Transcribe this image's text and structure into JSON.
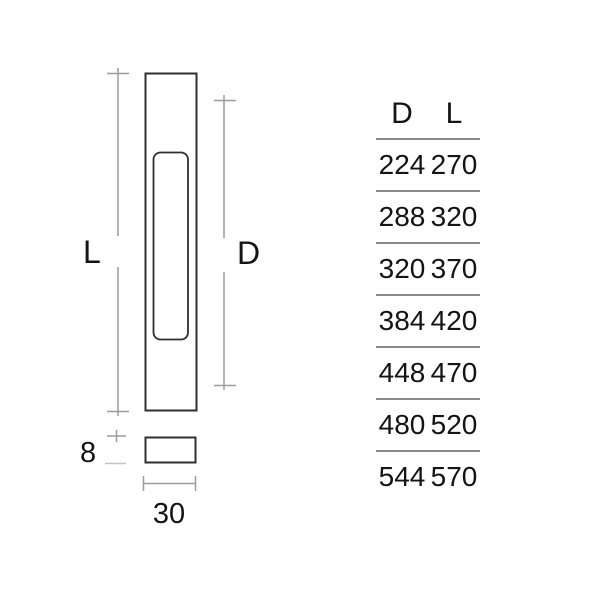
{
  "colors": {
    "background": "#ffffff",
    "stroke-dark": "#2f2f2f",
    "stroke-dim": "#9c9c9c",
    "stroke-dim-light": "#c4c4c4",
    "table-rule": "#8a8a8a",
    "text": "#141414"
  },
  "drawing": {
    "front_view": {
      "length_label": "L",
      "recess_label": "D"
    },
    "side_view": {
      "thickness_label": "8",
      "width_label": "30"
    }
  },
  "table": {
    "columns": [
      "D",
      "L"
    ],
    "rows": [
      {
        "d": "224",
        "l": "270"
      },
      {
        "d": "288",
        "l": "320"
      },
      {
        "d": "320",
        "l": "370"
      },
      {
        "d": "384",
        "l": "420"
      },
      {
        "d": "448",
        "l": "470"
      },
      {
        "d": "480",
        "l": "520"
      },
      {
        "d": "544",
        "l": "570"
      }
    ]
  }
}
